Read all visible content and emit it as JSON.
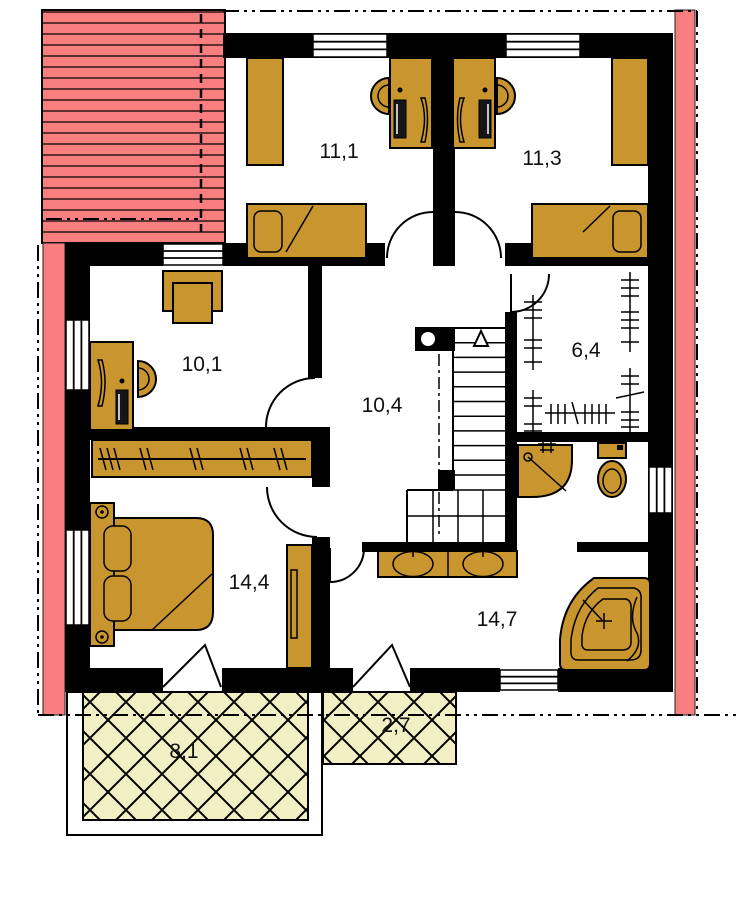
{
  "palette": {
    "wall": "#000000",
    "furniture": "#c9952f",
    "roof_overhang": "#f87e80",
    "terrace_fill": "#f2efc4",
    "background": "#ffffff"
  },
  "rooms": [
    {
      "id": "bedroom-top-left",
      "label": "11,1"
    },
    {
      "id": "bedroom-top-right",
      "label": "11,3"
    },
    {
      "id": "room-mid-left",
      "label": "10,1"
    },
    {
      "id": "hall-staircase",
      "label": "10,4"
    },
    {
      "id": "wardrobe-room",
      "label": "6,4"
    },
    {
      "id": "bedroom-bottom",
      "label": "14,4"
    },
    {
      "id": "bathroom",
      "label": "14,7"
    },
    {
      "id": "terrace-large",
      "label": "8,1"
    },
    {
      "id": "terrace-small",
      "label": "2,7"
    }
  ],
  "fixtures": {
    "bedroom-top-left": [
      "wardrobe",
      "desk",
      "monitor",
      "office-chair",
      "single-bed"
    ],
    "bedroom-top-right": [
      "wardrobe",
      "desk",
      "monitor",
      "office-chair",
      "single-bed"
    ],
    "room-mid-left": [
      "armchair",
      "desk",
      "monitor",
      "office-chair"
    ],
    "hall-staircase": [
      "staircase",
      "chimney",
      "up-arrow"
    ],
    "wardrobe-room": [
      "clothes-rails"
    ],
    "bedroom-bottom": [
      "closet-rail",
      "double-bed",
      "tall-wardrobe"
    ],
    "bathroom": [
      "double-vanity",
      "corner-shower",
      "toilet",
      "corner-bathtub"
    ],
    "terrace-large": [],
    "terrace-small": []
  }
}
